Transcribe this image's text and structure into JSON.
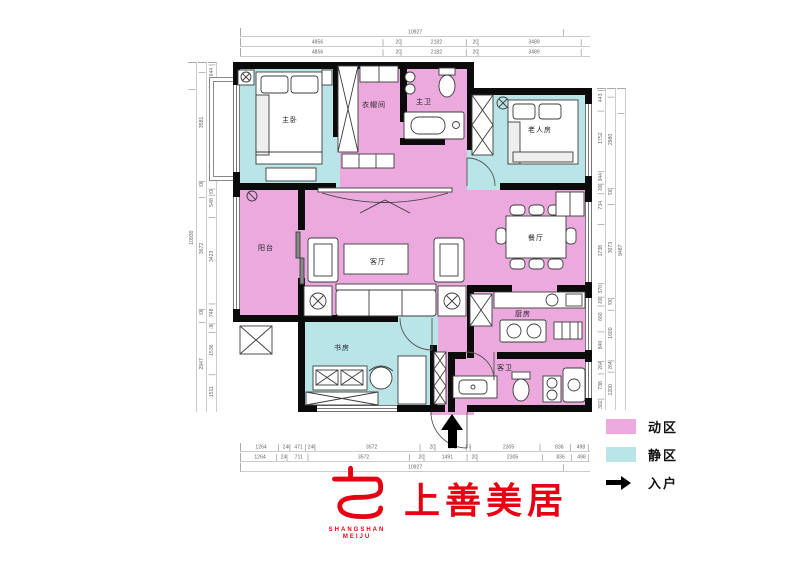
{
  "plan": {
    "zones": {
      "active_color": "#eba9de",
      "quiet_color": "#b9e5e8"
    },
    "rooms": {
      "master_bedroom": {
        "label": "主卧",
        "zone": "quiet"
      },
      "cloakroom": {
        "label": "衣帽间",
        "zone": "active"
      },
      "master_bath": {
        "label": "主卫",
        "zone": "active"
      },
      "elder_room": {
        "label": "老人房",
        "zone": "quiet"
      },
      "balcony": {
        "label": "阳台",
        "zone": "active"
      },
      "living_room": {
        "label": "客厅",
        "zone": "active"
      },
      "dining_room": {
        "label": "餐厅",
        "zone": "active"
      },
      "kitchen": {
        "label": "厨房",
        "zone": "active"
      },
      "guest_bath": {
        "label": "客卫",
        "zone": "active"
      },
      "study": {
        "label": "书房",
        "zone": "quiet"
      }
    }
  },
  "dimensions": {
    "top": {
      "total": [
        "10927"
      ],
      "row1": [
        "4856",
        "200",
        "2182",
        "200",
        "3489"
      ],
      "row2": [
        "4856",
        "200",
        "2182",
        "200",
        "3489"
      ]
    },
    "bottom": {
      "row1": [
        "1264",
        "240",
        "471",
        "240",
        "3572",
        "202",
        "971",
        "78",
        "2305",
        "836",
        "498"
      ],
      "row2": [
        "1264",
        "240",
        "711",
        "3572",
        "200",
        "1491",
        "200",
        "2305",
        "836",
        "498"
      ],
      "total": [
        "10927"
      ]
    },
    "left": {
      "total": [
        "10930"
      ],
      "mid": [
        "3581",
        "200",
        "3672",
        "200",
        "2947"
      ],
      "inner": [
        "644",
        "3077",
        "860",
        "200",
        "548",
        "3423",
        "748",
        "190",
        "1536",
        "1511"
      ]
    },
    "right": {
      "inner": [
        "443",
        "1752",
        "344",
        "200",
        "734",
        "1738",
        "370",
        "200",
        "660",
        "840",
        "264",
        "738",
        "302"
      ],
      "mid": [
        "2980",
        "200",
        "3073",
        "200",
        "1600",
        "264",
        "1200"
      ],
      "total": [
        "9487"
      ]
    }
  },
  "legend": {
    "active": {
      "label": "动区",
      "color": "#eba9de"
    },
    "quiet": {
      "label": "静区",
      "color": "#b9e5e8"
    },
    "entry": {
      "label": "入户"
    }
  },
  "logo": {
    "cn": "上善美居",
    "en1": "SHANGSHAN",
    "en2": "MEIJU",
    "color": "#e50012"
  }
}
